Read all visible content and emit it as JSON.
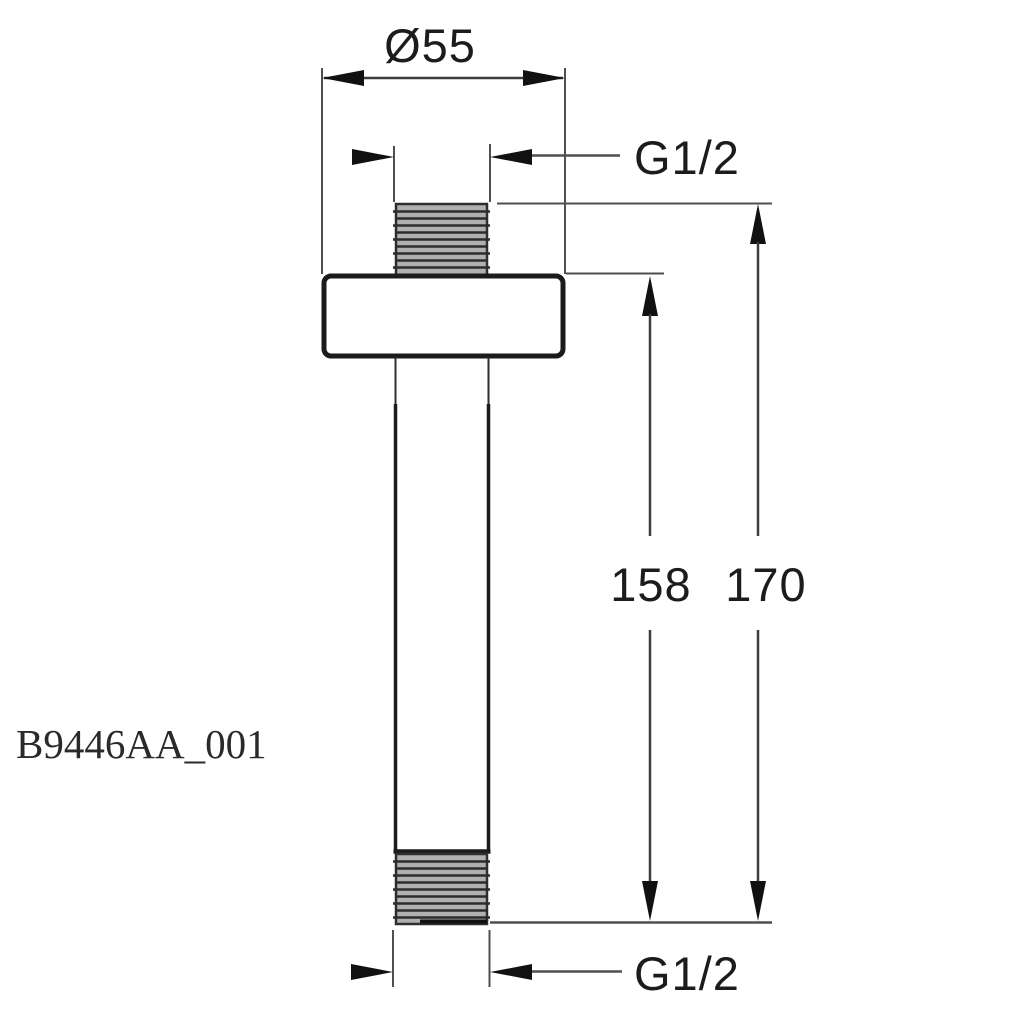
{
  "part_number": "B9446AA_001",
  "dimensions": {
    "diameter": "Ø55",
    "thread_top": "G1/2",
    "thread_bottom": "G1/2",
    "length_to_flange": "158",
    "length_overall": "170"
  },
  "colors": {
    "background": "#ffffff",
    "outline": "#1b1b1b",
    "dimension_line": "#4f4f4f",
    "arrow_fill": "#111111",
    "thread_fill": "#b0b0b0",
    "thread_stripe": "#2c2c2c",
    "text": "#1c1c1c"
  }
}
